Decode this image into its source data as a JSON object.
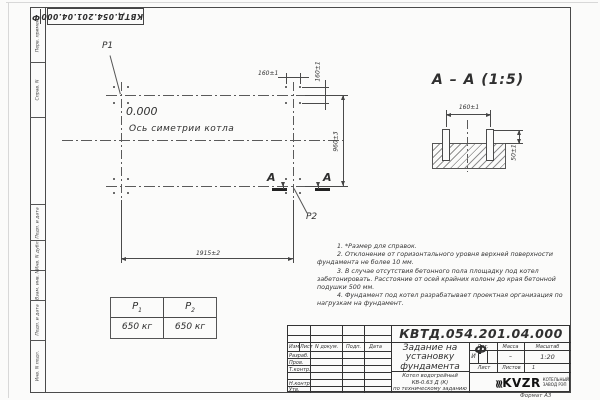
{
  "stamp": {
    "code": "КВТД.054.201.04.000",
    "suffix": "Ф"
  },
  "frame_labels": [
    "Перв. примен.",
    "Справ. N",
    "Подп. и дата",
    "Инв. N дубл.",
    "Взам. инв. N",
    "Подп. и дата",
    "Инв. N подл."
  ],
  "plan": {
    "level_mark": "0.000",
    "axis_label": "Ось симетрии котла",
    "p1_label": "P1",
    "p2_label": "P2",
    "section_letter": "А",
    "dims": {
      "d160h": "160±1",
      "d160v": "160±1",
      "d960": "960±3",
      "d1915": "1915±2"
    }
  },
  "section": {
    "title": "А – А (1:5)",
    "dim160": "160±1",
    "dim50": "50±1"
  },
  "notes": [
    "1. *Размер для справок.",
    "2. Отклонение от горизонтального уровня верхней поверхности фундамента не более 10 мм.",
    "3. В случае отсутствия бетонного пола площадку под котел забетонировать. Расстояние от осей крайних колонн до края бетонной подушки 500 мм.",
    "4. Фундамент под котел разрабатывает проектная организация по нагрузкам на фундамент."
  ],
  "load_table": {
    "cols": [
      {
        "sym": "P",
        "sub": "1"
      },
      {
        "sym": "P",
        "sub": "2"
      }
    ],
    "values": [
      "650 кг",
      "650 кг"
    ]
  },
  "title_block": {
    "doc_number": "КВТД.054.201.04.000  Ф",
    "header_cells": [
      "Изм.",
      "Лист",
      "N докум.",
      "Подп.",
      "Дата"
    ],
    "sign_rows": [
      "Разраб.",
      "Пров.",
      "Т.контр.",
      "Н.контр.",
      "Утв."
    ],
    "title_lines": [
      "Задание на",
      "установку",
      "фундамента"
    ],
    "subtitle_lines": [
      "Котел водогрейный",
      "КВ-0.63 Д (К)",
      "по техническому заданию"
    ],
    "lit_label": "Лит.",
    "lit_value": "И",
    "mass_label": "Масса",
    "mass_value": "–",
    "scale_label": "Масштаб",
    "scale_value": "1:20",
    "sheet_label": "Лист",
    "sheets_label": "Листов",
    "sheets_value": "1",
    "logo_name": "KVZR",
    "logo_sub1": "КОТЕЛЬНЫЙ",
    "logo_sub2": "ЗАВОД РЭП",
    "format_note": "Формат А3"
  },
  "colors": {
    "line": "#4a4a4a",
    "paper": "#fbfbfa",
    "ink": "#2f2f2f"
  }
}
